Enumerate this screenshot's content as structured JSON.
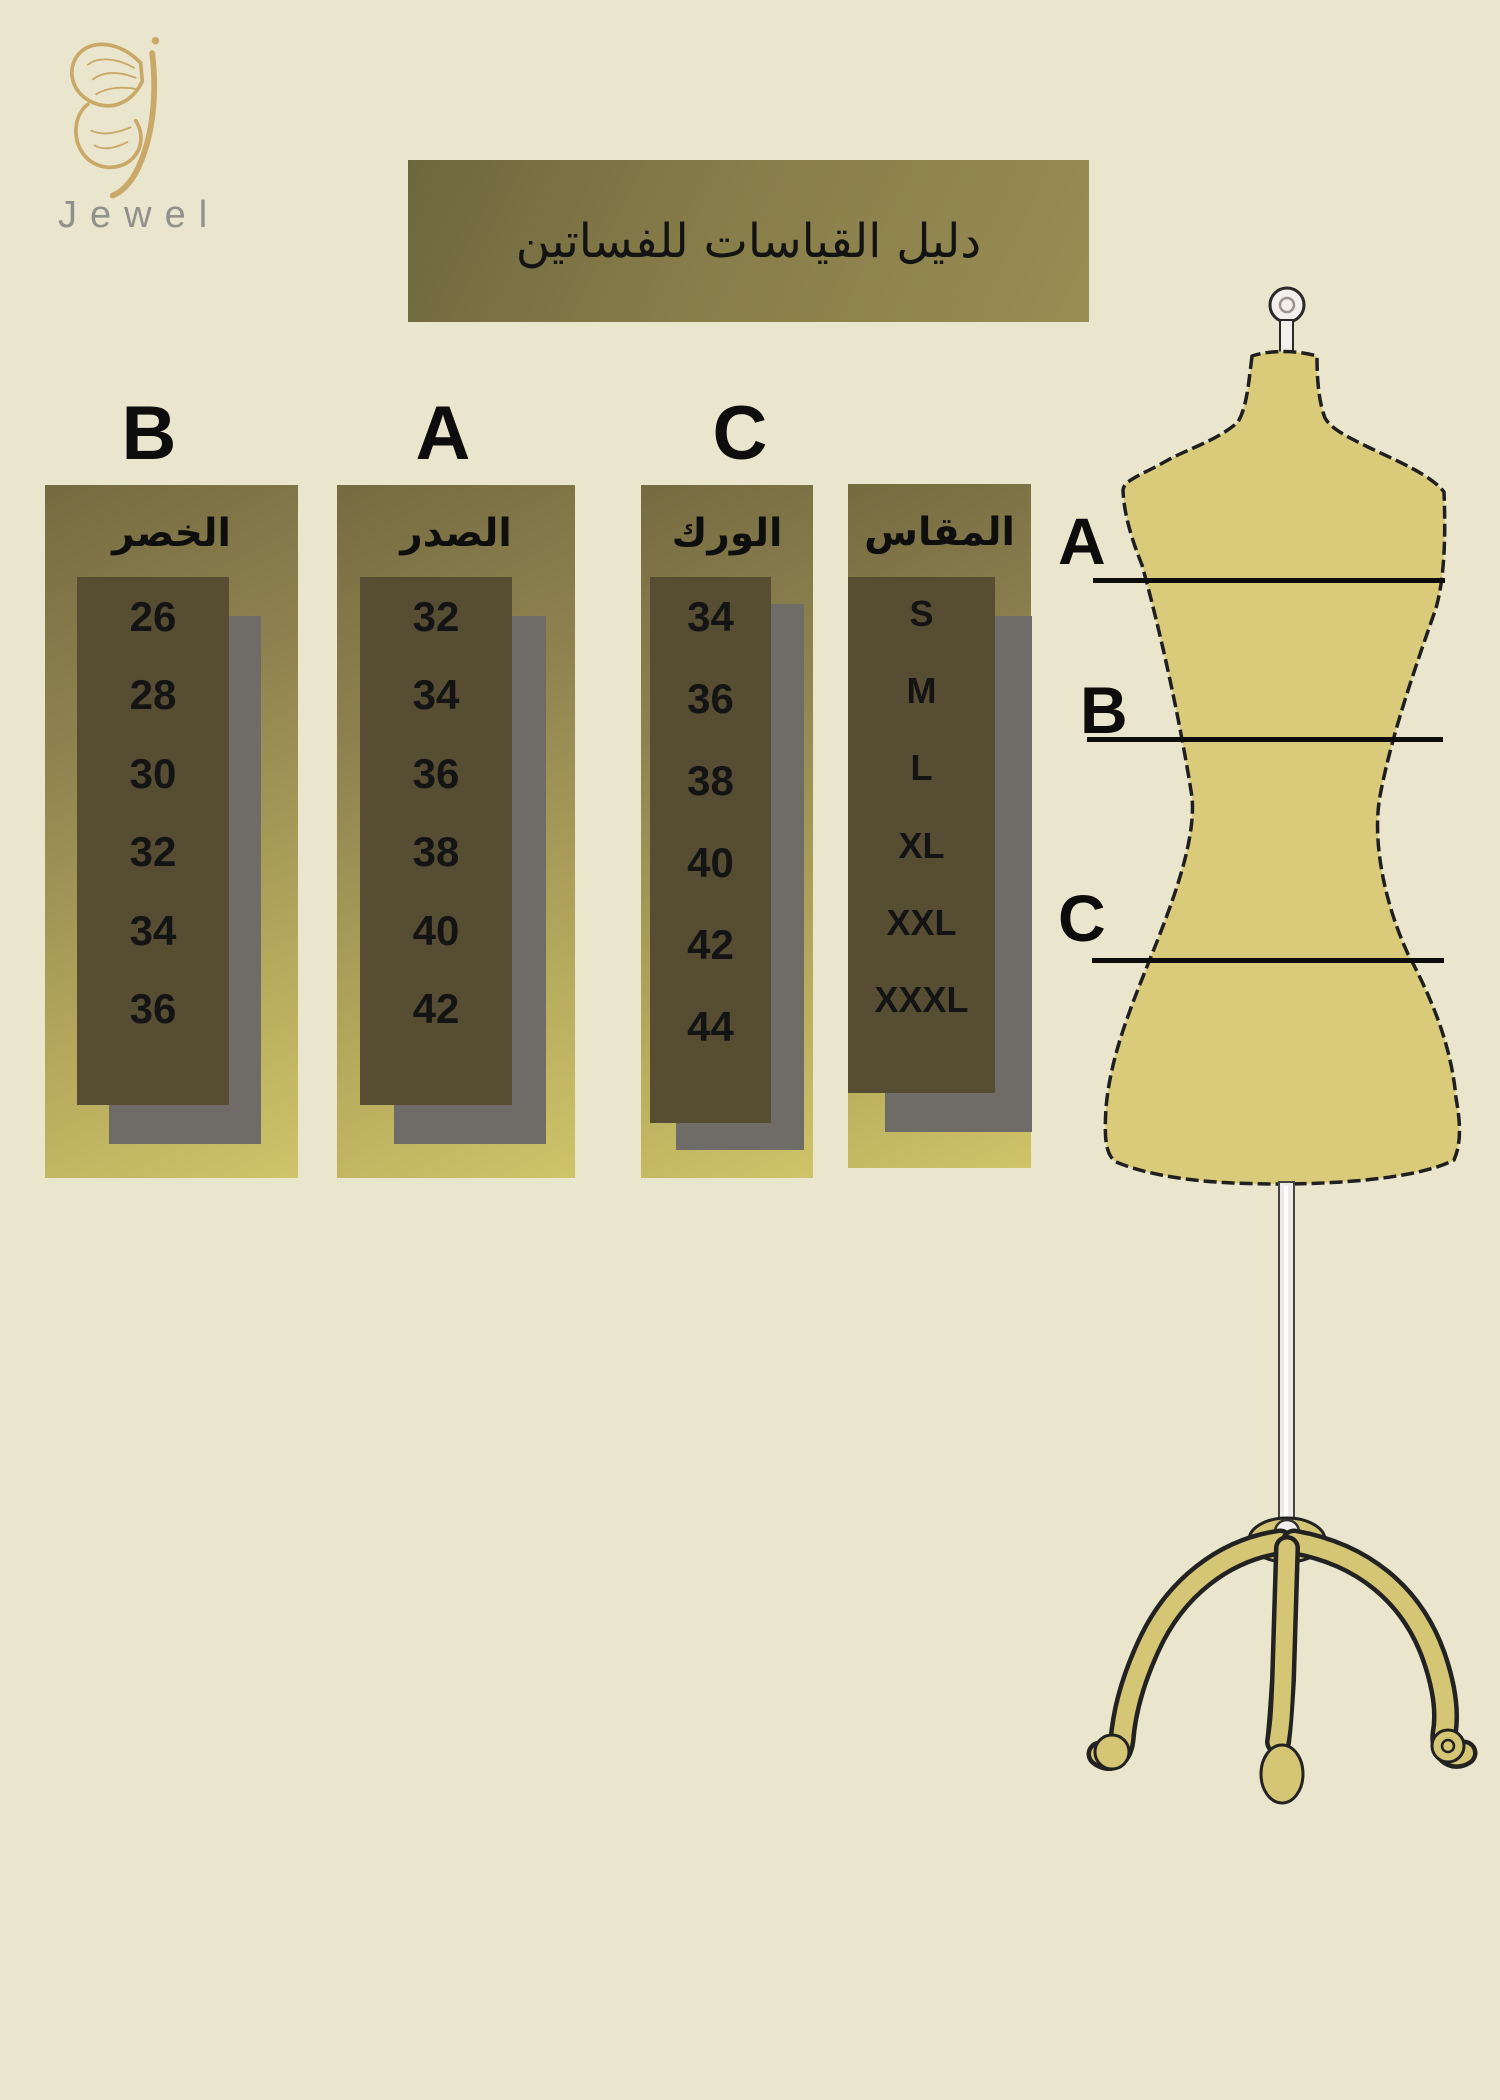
{
  "brand": {
    "name": "Jewel"
  },
  "title": {
    "text": "دليل القياسات للفساتين"
  },
  "size_chart": {
    "columns": [
      {
        "letter": "B",
        "header": "الخصر",
        "values": [
          "26",
          "28",
          "30",
          "32",
          "34",
          "36"
        ]
      },
      {
        "letter": "A",
        "header": "الصدر",
        "values": [
          "32",
          "34",
          "36",
          "38",
          "40",
          "42"
        ]
      },
      {
        "letter": "C",
        "header": "الورك",
        "values": [
          "34",
          "36",
          "38",
          "40",
          "42",
          "44"
        ]
      },
      {
        "letter": "",
        "header": "المقاس",
        "values": [
          "S",
          "M",
          "L",
          "XL",
          "XXL",
          "XXXL"
        ]
      }
    ]
  },
  "mannequin": {
    "label_a": "A",
    "label_b": "B",
    "label_c": "C"
  },
  "colors": {
    "background": "#EAE6CE",
    "banner_olive": "#877D4A",
    "panel_yellow": "#CCC166",
    "box_dark": "#564D33",
    "shadow_gray": "#6F6B66",
    "mannequin_fill": "#D9CB7A",
    "logo_gold": "#C9A868",
    "wordmark_gray": "#90908C",
    "text_black": "#131313"
  }
}
